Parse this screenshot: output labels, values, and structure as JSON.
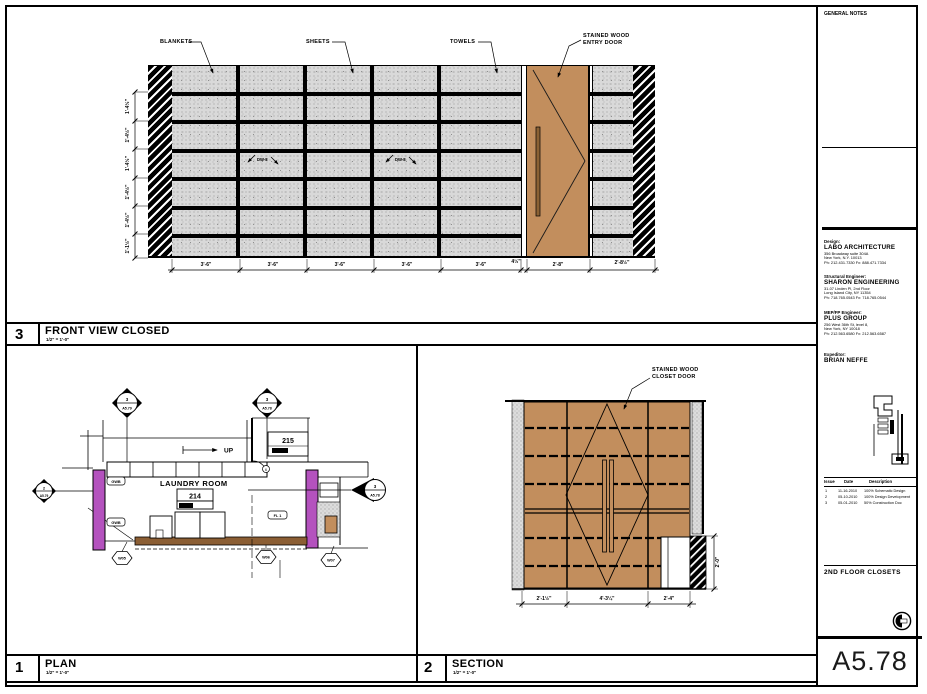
{
  "sheet": {
    "number": "A5.78",
    "title": "2ND FLOOR CLOSETS",
    "general_notes": "GENERAL NOTES"
  },
  "firms": {
    "design_label": "Design:",
    "design_name": "LABO ARCHITECTURE",
    "design_addr1": "356 Broadway suite 304A",
    "design_addr2": "New York, N.Y. 10013",
    "design_phone": "Ph: 212.431.7330    Fx: 888.471.7334",
    "struct_label": "Structural Engineer:",
    "struct_name": "SHARON ENGINEERING",
    "struct_addr1": "31-07 Linden Pl, 2nd Floor",
    "struct_addr2": "Long Island City, NY 11354",
    "struct_phone": "Ph: 718.765.0543    Fx: 718.765.0544",
    "mep_label": "MEP/FP Engineer:",
    "mep_name": "PLUS GROUP",
    "mep_addr1": "256 West 36th St, level 8,",
    "mep_addr2": "New York, NY 10018",
    "mep_phone": "Ph: 212.563.6580    Fx: 212.563.6587",
    "exp_label": "Expeditor:",
    "exp_name": "BRIAN NEFFE"
  },
  "revisions": {
    "h_issue": "Issue",
    "h_date": "Date",
    "h_desc": "Description",
    "rows": [
      {
        "no": "1",
        "date": "11-16-2010",
        "desc": "100% Schematic Design"
      },
      {
        "no": "2",
        "date": "05-10-2010",
        "desc": "100% Design Development"
      },
      {
        "no": "3",
        "date": "05-01-2010",
        "desc": "50% Construction Doc"
      }
    ]
  },
  "front_view": {
    "number": "3",
    "title": "FRONT VIEW CLOSED",
    "scale": "1/2\" = 1'-0\"",
    "label_blankets": "BLANKETS",
    "label_sheets": "SHEETS",
    "label_towels": "TOWELS",
    "label_door_1": "STAINED WOOD",
    "label_door_2": "ENTRY DOOR",
    "tag_dw": "DW-8",
    "dims_bottom": [
      "3'-6\"",
      "3'-6\"",
      "3'-6\"",
      "3'-6\"",
      "3'-6\"",
      "4½\"",
      "2'-8\"",
      "2'-8½\""
    ],
    "dims_left": [
      "1'-4½\"",
      "1'-4½\"",
      "1'-4½\"",
      "1'-4½\"",
      "1'-4½\"",
      "1'-1½\""
    ]
  },
  "plan_view": {
    "number": "1",
    "title": "PLAN",
    "scale": "1/2\" = 1'-0\"",
    "room_name": "LAUNDRY ROOM",
    "room_number": "214",
    "adj_room_number": "215",
    "up": "UP",
    "tag_gwb": "GWB",
    "tag_fl": "FL 1",
    "tag_w05": "W05",
    "tag_w06": "W06",
    "tag_w07": "W07",
    "door_tag": "6",
    "marker1_num": "3",
    "marker1_sheet": "A5.79",
    "marker2_num": "3",
    "marker2_sheet": "A5.78",
    "marker3_num": "3",
    "marker3_sheet": "A5.78",
    "marker4_num": "2",
    "marker4_sheet": "A5.79"
  },
  "section_view": {
    "number": "2",
    "title": "SECTION",
    "scale": "1/2\" = 1'-0\"",
    "label_door_1": "STAINED WOOD",
    "label_door_2": "CLOSET DOOR",
    "dims_bottom": [
      "2'-1½\"",
      "4'-3¼\"",
      "2'-4\""
    ],
    "dim_right": "2'-0\""
  }
}
